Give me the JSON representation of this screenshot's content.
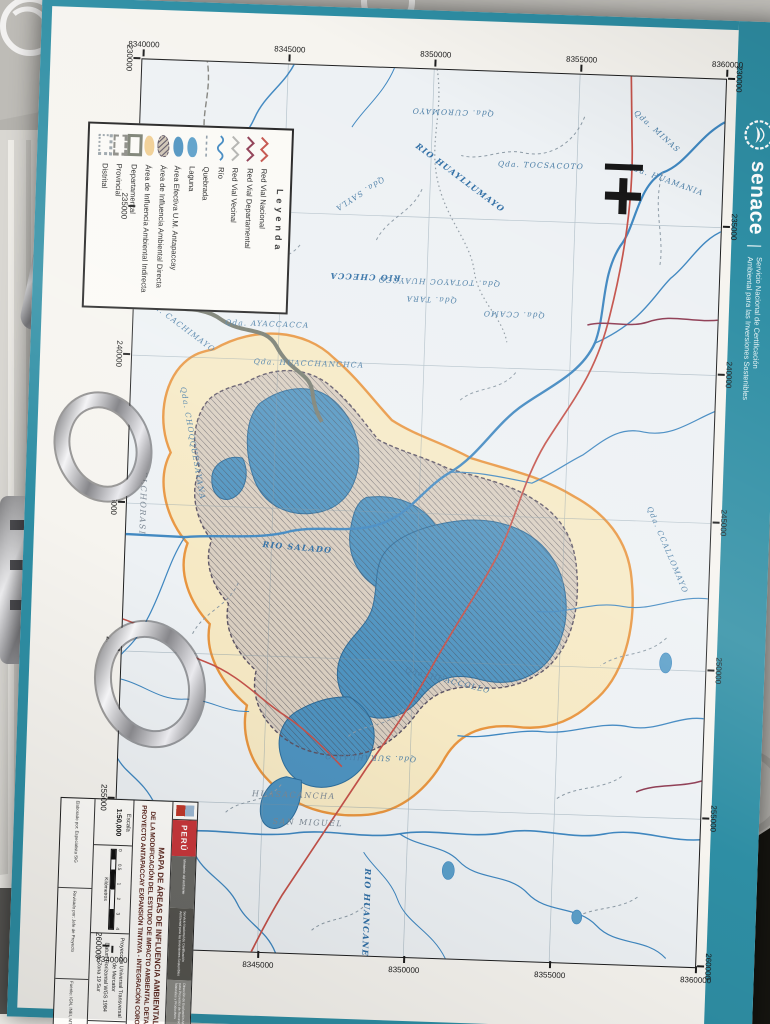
{
  "branding": {
    "wordmark": "senace",
    "divider": "|",
    "tagline_line1": "Servicio Nacional de Certificación",
    "tagline_line2": "Ambiental para las Inversiones Sostenibles",
    "logo": "senace-emblem-icon",
    "band_color": "#2e8ea4"
  },
  "map": {
    "north_arrow_icon": "north-cross-icon",
    "eastings": [
      "230000",
      "235000",
      "240000",
      "245000",
      "250000",
      "255000",
      "260000"
    ],
    "northings": [
      "8360000",
      "8355000",
      "8350000",
      "8345000",
      "8340000"
    ],
    "labels": [
      {
        "text": "Qda. CUROMAYO",
        "x": 42,
        "y": 272,
        "r": 90,
        "kind": "q"
      },
      {
        "text": "Qda. TOCSACOTO",
        "x": 92,
        "y": 182,
        "r": -90,
        "kind": "q"
      },
      {
        "text": "Qda. MINAS",
        "x": 54,
        "y": 67,
        "r": -50,
        "kind": "q"
      },
      {
        "text": "Qda. HUAMANIA",
        "x": 102,
        "y": 57,
        "r": -72,
        "kind": "q"
      },
      {
        "text": "RIO HUAYLLUMAYO",
        "x": 107,
        "y": 262,
        "r": -55,
        "kind": "r"
      },
      {
        "text": "Qda. SAYLA",
        "x": 127,
        "y": 362,
        "r": 55,
        "kind": "q"
      },
      {
        "text": "RIO CHECCA",
        "x": 210,
        "y": 354,
        "r": 90,
        "kind": "r"
      },
      {
        "text": "Qda. TOTAYOC HUAYCCO",
        "x": 212,
        "y": 280,
        "r": 90,
        "kind": "q"
      },
      {
        "text": "Qda. TARA",
        "x": 230,
        "y": 287,
        "r": 90,
        "kind": "q"
      },
      {
        "text": "Qda. CCAMO",
        "x": 242,
        "y": 204,
        "r": 90,
        "kind": "q"
      },
      {
        "text": "Qda. AYACCACCA",
        "x": 260,
        "y": 450,
        "r": -90,
        "kind": "q"
      },
      {
        "text": "Qda. CACHIMAYO",
        "x": 264,
        "y": 537,
        "r": -55,
        "kind": "q"
      },
      {
        "text": "Qda. CHOQQUESAYANA",
        "x": 382,
        "y": 520,
        "r": -12,
        "kind": "q"
      },
      {
        "text": "MELCHORASI",
        "x": 439,
        "y": 568,
        "r": 0,
        "kind": "loc"
      },
      {
        "text": "Qda. HUACCHANCHCA",
        "x": 298,
        "y": 407,
        "r": -90,
        "kind": "q"
      },
      {
        "text": "RIO SALADO",
        "x": 482,
        "y": 412,
        "r": -87,
        "kind": "r"
      },
      {
        "text": "Qda. CCALLOMAYO",
        "x": 472,
        "y": 42,
        "r": -25,
        "kind": "q"
      },
      {
        "text": "Qda. HUACCOLLO",
        "x": 610,
        "y": 257,
        "r": -78,
        "kind": "q"
      },
      {
        "text": "Qda. SURAHUAICO",
        "x": 690,
        "y": 332,
        "r": 90,
        "kind": "q"
      },
      {
        "text": "HUASACANCHA",
        "x": 730,
        "y": 407,
        "r": -90,
        "kind": "loc"
      },
      {
        "text": "SAN MIGUEL",
        "x": 757,
        "y": 392,
        "r": -90,
        "kind": "loc"
      },
      {
        "text": "RIO HUANCANE",
        "x": 845,
        "y": 330,
        "r": 0,
        "kind": "r"
      }
    ]
  },
  "legend": {
    "title": "Leyenda",
    "items": [
      {
        "label": "Red Vial Nacional",
        "kind": "zigzag",
        "color": "#c4524a"
      },
      {
        "label": "Red Vial Departamental",
        "kind": "zigzag",
        "color": "#8e3b52"
      },
      {
        "label": "Red Vial Vecinal",
        "kind": "zigzag",
        "color": "#b3b3b0"
      },
      {
        "label": "Río",
        "kind": "wave",
        "color": "#3f87c0"
      },
      {
        "label": "Quebrada",
        "kind": "dash",
        "color": "#8d9ba6"
      },
      {
        "label": "Laguna",
        "kind": "blob",
        "color": "#5b9fc9"
      },
      {
        "label": "Área Efectiva U.M. Antapaccay",
        "kind": "blob",
        "color": "#4e93c0"
      },
      {
        "label": "Área de Influencia Ambiental Directa",
        "kind": "hatchblob",
        "color": "#8d7e96"
      },
      {
        "label": "Área de Influencia Ambiental Indirecta",
        "kind": "blob",
        "color": "#f0ce92"
      },
      {
        "label": "Departamental",
        "kind": "bracket",
        "color": "#7a7f72",
        "style": "solid"
      },
      {
        "label": "Provincial",
        "kind": "bracket",
        "color": "#8a8a84",
        "style": "dashed"
      },
      {
        "label": "Distrital",
        "kind": "bracket",
        "color": "#9aa4aa",
        "style": "dotted"
      }
    ]
  },
  "title_block": {
    "country": "PERÚ",
    "ministry_blocks": [
      "Ministerio del Ambiente",
      "Servicio Nacional de Certificación Ambiental para las Inversiones Sostenibles",
      "Dirección de Evaluación Ambiental para Proyectos de Recursos Naturales y Productivos"
    ],
    "title_lines": [
      "MAPA DE ÁREAS DE INFLUENCIA AMBIENTAL",
      "DE LA MODIFICACIÓN DEL ESTUDIO DE IMPACTO AMBIENTAL DETALLADO DEL",
      "PROYECTO ANTAPACCAY EXPANSIÓN TINTAYA - INTEGRACIÓN COROCCOHUAYCO"
    ],
    "escala_label": "Escala",
    "escala_value": "1:50,000",
    "scalebar": {
      "ticks": [
        "0",
        "0.5",
        "1",
        "2",
        "3",
        "4"
      ],
      "unit": "Kilómetros"
    },
    "proyeccion_lines": [
      "Proyección Universal Transversal de Mercator",
      "Datum Horizontal WGS 1984 Zona 19 Sur"
    ],
    "fecha_label": "Fecha",
    "fecha_value": "Noviembre 2018",
    "credits": [
      "Elaborado por: Especialista SIG",
      "Revisado por: Jefe de Proyecto",
      "Fuente: IGN, INEI, MTC 2018"
    ]
  },
  "binder": {
    "brand": "office"
  }
}
